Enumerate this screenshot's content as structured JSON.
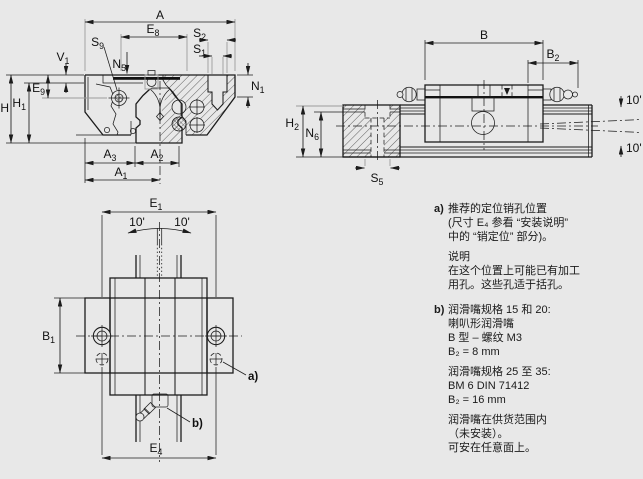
{
  "meta": {
    "background": "#e8e8e8",
    "line_color": "#1c1c1c",
    "gray_line_color": "#9b9b9b",
    "figure_kind": "linear-guide-carriage-dimension-drawing"
  },
  "views": {
    "front_section": {
      "dims": {
        "A": {
          "m": "A",
          "s": ""
        },
        "E8": {
          "m": "E",
          "s": "8"
        },
        "S2": {
          "m": "S",
          "s": "2"
        },
        "S1": {
          "m": "S",
          "s": "1"
        },
        "S9": {
          "m": "S",
          "s": "9"
        },
        "N5": {
          "m": "N",
          "s": "5"
        },
        "V1": {
          "m": "V",
          "s": "1"
        },
        "E9": {
          "m": "E",
          "s": "9"
        },
        "H1": {
          "m": "H",
          "s": "1"
        },
        "H": {
          "m": "H",
          "s": ""
        },
        "N1": {
          "m": "N",
          "s": "1"
        },
        "A3": {
          "m": "A",
          "s": "3"
        },
        "A2": {
          "m": "A",
          "s": "2"
        },
        "A1": {
          "m": "A",
          "s": "1"
        }
      }
    },
    "side": {
      "dims": {
        "B": {
          "m": "B",
          "s": ""
        },
        "B2": {
          "m": "B",
          "s": "2"
        },
        "H2": {
          "m": "H",
          "s": "2"
        },
        "N6": {
          "m": "N",
          "s": "6"
        },
        "S5": {
          "m": "S",
          "s": "5"
        },
        "angle_top": "10'",
        "angle_bottom": "10'"
      }
    },
    "plan": {
      "dims": {
        "E1": {
          "m": "E",
          "s": "1"
        },
        "B1": {
          "m": "B",
          "s": "1"
        },
        "E4": {
          "m": "E",
          "s": "4"
        },
        "angle_left": "10'",
        "angle_right": "10'"
      },
      "callout_a": "a)",
      "callout_b": "b)"
    }
  },
  "notes": {
    "a_marker": "a)",
    "a_lines": [
      "推荐的定位销孔位置",
      "(尺寸 E₄ 参看 “安装说明”",
      "中的 “销定位” 部分)。"
    ],
    "remark_lines": [
      "说明",
      "在这个位置上可能已有加工",
      "用孔。这些孔适于括孔。"
    ],
    "b_marker": "b)",
    "b_lines": [
      "润滑嘴规格 15 和 20:",
      "喇叭形润滑嘴",
      "B 型 – 螺纹 M3",
      "B₂ = 8 mm"
    ],
    "b2_lines": [
      "润滑嘴规格 25 至 35:",
      "BM 6 DIN 71412",
      "B₂ = 16 mm"
    ],
    "b3_lines": [
      "润滑嘴在供货范围内",
      "（未安装）。",
      "可安在任意面上。"
    ]
  }
}
